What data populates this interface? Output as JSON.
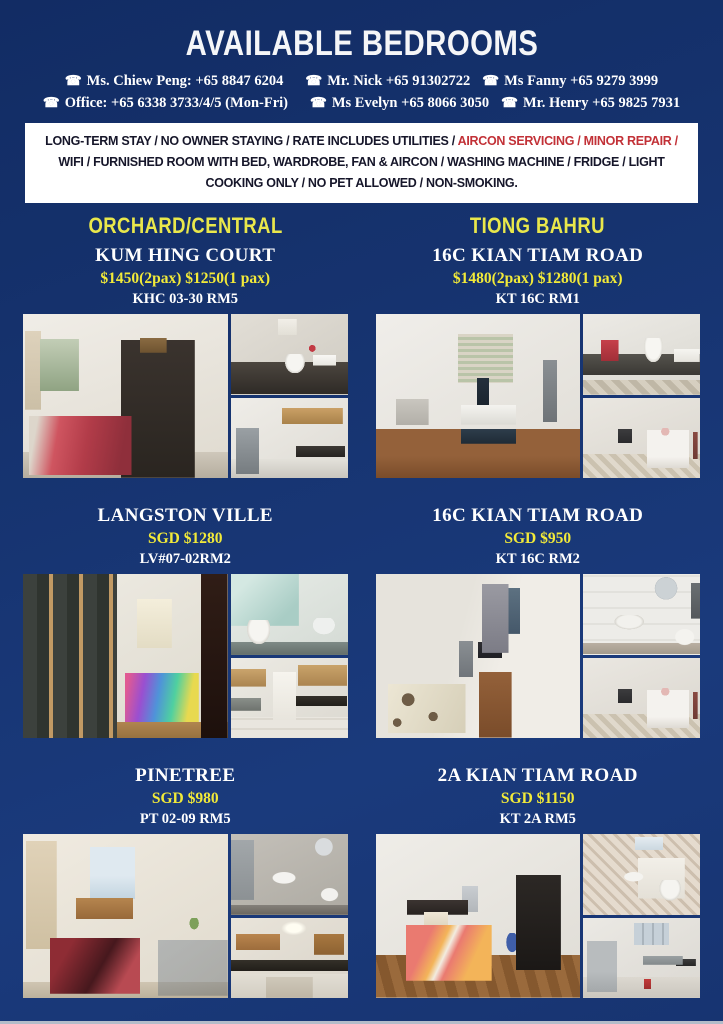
{
  "header": {
    "title": "AVAILABLE BEDROOMS"
  },
  "contacts": {
    "phone_icon": "☎",
    "line1": [
      "Ms. Chiew Peng: +65 8847 6204",
      "Mr. Nick +65 91302722",
      "Ms Fanny +65 9279 3999"
    ],
    "line2": [
      "Office: +65 6338 3733/4/5 (Mon-Fri)",
      "Ms Evelyn +65 8066 3050",
      "Mr. Henry +65 9825 7931"
    ]
  },
  "terms": {
    "part1": "LONG-TERM STAY / NO OWNER STAYING / RATE INCLUDES UTILITIES / ",
    "highlight": "AIRCON SERVICING / MINOR REPAIR /",
    "part2": " WIFI / FURNISHED ROOM WITH BED, WARDROBE, FAN & AIRCON / WASHING MACHINE / FRIDGE / LIGHT COOKING ONLY / NO PET ALLOWED / NON-SMOKING."
  },
  "sections": [
    {
      "label": "ORCHARD/CENTRAL"
    },
    {
      "label": "TIONG BAHRU"
    }
  ],
  "listings": [
    {
      "name": "KUM HING COURT",
      "price": "$1450(2pax) $1250(1 pax)",
      "code": "KHC 03-30 RM5",
      "photos": [
        "bedroom",
        "bathroom",
        "kitchen"
      ]
    },
    {
      "name": "16C KIAN TIAM ROAD",
      "price": "$1480(2pax) $1280(1 pax)",
      "code": "KT 16C RM1",
      "photos": [
        "bedroom",
        "bathroom",
        "hallway"
      ]
    },
    {
      "name": "LANGSTON VILLE",
      "price": "SGD $1280",
      "code": "LV#07-02RM2",
      "photos": [
        "bedroom",
        "bathroom",
        "kitchen"
      ]
    },
    {
      "name": "16C KIAN TIAM ROAD",
      "price": "SGD $950",
      "code": "KT 16C RM2",
      "photos": [
        "bedroom",
        "bathroom",
        "hallway"
      ]
    },
    {
      "name": "PINETREE",
      "price": "SGD $980",
      "code": "PT 02-09 RM5",
      "photos": [
        "bedroom",
        "bathroom",
        "kitchen"
      ]
    },
    {
      "name": "2A KIAN TIAM ROAD",
      "price": "SGD $1150",
      "code": "KT 2A RM5",
      "photos": [
        "bedroom",
        "bathroom",
        "kitchen"
      ]
    }
  ],
  "colors": {
    "background_navy": "#16336f",
    "accent_yellow": "#e9e74b",
    "price_yellow": "#f2ea39",
    "highlight_red": "#c23137",
    "text_white": "#ffffff",
    "terms_background": "#ffffff"
  }
}
